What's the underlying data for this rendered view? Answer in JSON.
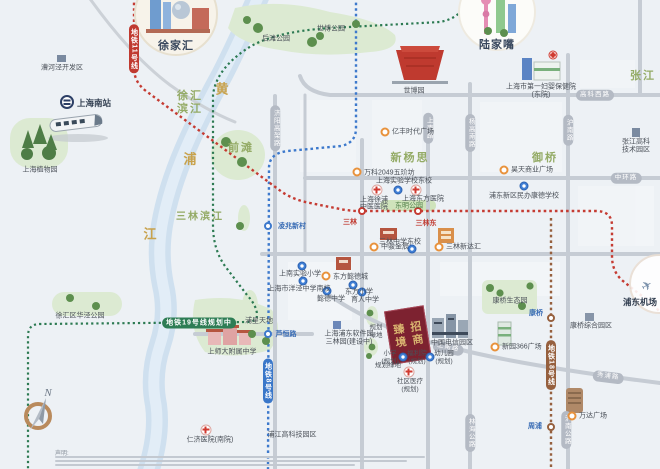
{
  "areas": {
    "xujiahui": "徐家汇",
    "lujiazui": "陆家嘴",
    "xuhui_bj_1": "徐汇",
    "xuhui_bj_2": "滨江",
    "qiantan": "前滩",
    "sanlin_bj": "三林滨江",
    "xinyangsi": "新杨思",
    "yuqiao": "御桥",
    "zhangjiang": "张江",
    "airport": "浦东机场"
  },
  "river": {
    "c1": "黄",
    "c2": "浦",
    "c3": "江"
  },
  "metro": {
    "l11": "地铁11号线",
    "l8": "地铁8号线",
    "l18": "地铁18号线",
    "l19": "地铁19号线规划中"
  },
  "stations": {
    "sanlin": "三林",
    "sanlindong": "三林东",
    "lingzhao": "凌兆新村",
    "luheng": "芦恒路",
    "kangqiao": "康桥",
    "zhoupu": "周浦"
  },
  "roads": {
    "gaokexi": "高科西路",
    "zhonghuan": "中环路",
    "shangnan_v": "上南路",
    "shangnan_d": "上南路",
    "xiupu": "秀浦路",
    "yanggaonan": "杨高南路",
    "hunan": "沪南路",
    "linhai": "林海公路",
    "hunan_gl": "沪南公路",
    "jiyang": "济阳高架路"
  },
  "project": {
    "right": "招商",
    "left": "臻境"
  },
  "compass": {
    "n": "N"
  },
  "disclaimer": {
    "title": "声明:"
  },
  "pois": [
    {
      "t": "漕河泾开发区"
    },
    {
      "t": "上海南站"
    },
    {
      "t": "上海植物园"
    },
    {
      "t": "后滩公园"
    },
    {
      "t": "世博公园"
    },
    {
      "t": "世博园"
    },
    {
      "t": "亿丰时代广场"
    },
    {
      "t": "上海市第一妇婴保健院"
    },
    {
      "t": "(东院)"
    },
    {
      "t": "张江高科"
    },
    {
      "t": "技术园区"
    },
    {
      "t": "万科2049五玠坊"
    },
    {
      "t": "上海实验学校东校"
    },
    {
      "t": "上海徐浦"
    },
    {
      "t": "中医医院"
    },
    {
      "t": "上海东方医院"
    },
    {
      "t": "东明公园"
    },
    {
      "t": "三林中学东校"
    },
    {
      "t": "中骏金辰"
    },
    {
      "t": "三林新达汇"
    },
    {
      "t": "上南实验小学"
    },
    {
      "t": "东方懿德城"
    },
    {
      "t": "上海市洋泾中学南校"
    },
    {
      "t": "懿德中学"
    },
    {
      "t": "东方小学"
    },
    {
      "t": "育人中学"
    },
    {
      "t": "徐汇区华泾公园"
    },
    {
      "t": "浦星天地"
    },
    {
      "t": "上师大附属中学"
    },
    {
      "t": "上海浦东软件园"
    },
    {
      "t": "三林园(建设中)"
    },
    {
      "t": "规划"
    },
    {
      "t": "绿地"
    },
    {
      "t": "规划绿地"
    },
    {
      "t": "小学"
    },
    {
      "t": "(规划)"
    },
    {
      "t": "福利院"
    },
    {
      "t": "(规划)"
    },
    {
      "t": "幼儿园"
    },
    {
      "t": "(规划)"
    },
    {
      "t": "社区医疗"
    },
    {
      "t": "(规划)"
    },
    {
      "t": "中国电信园区"
    },
    {
      "t": "新园366广场"
    },
    {
      "t": "康桥生态园"
    },
    {
      "t": "康桥综合园区"
    },
    {
      "t": "万达广场"
    },
    {
      "t": "仁济医院(南院)"
    },
    {
      "t": "浦江高科技园区"
    },
    {
      "t": "昊天商业广场"
    },
    {
      "t": "浦东新区民办康德学校"
    }
  ]
}
